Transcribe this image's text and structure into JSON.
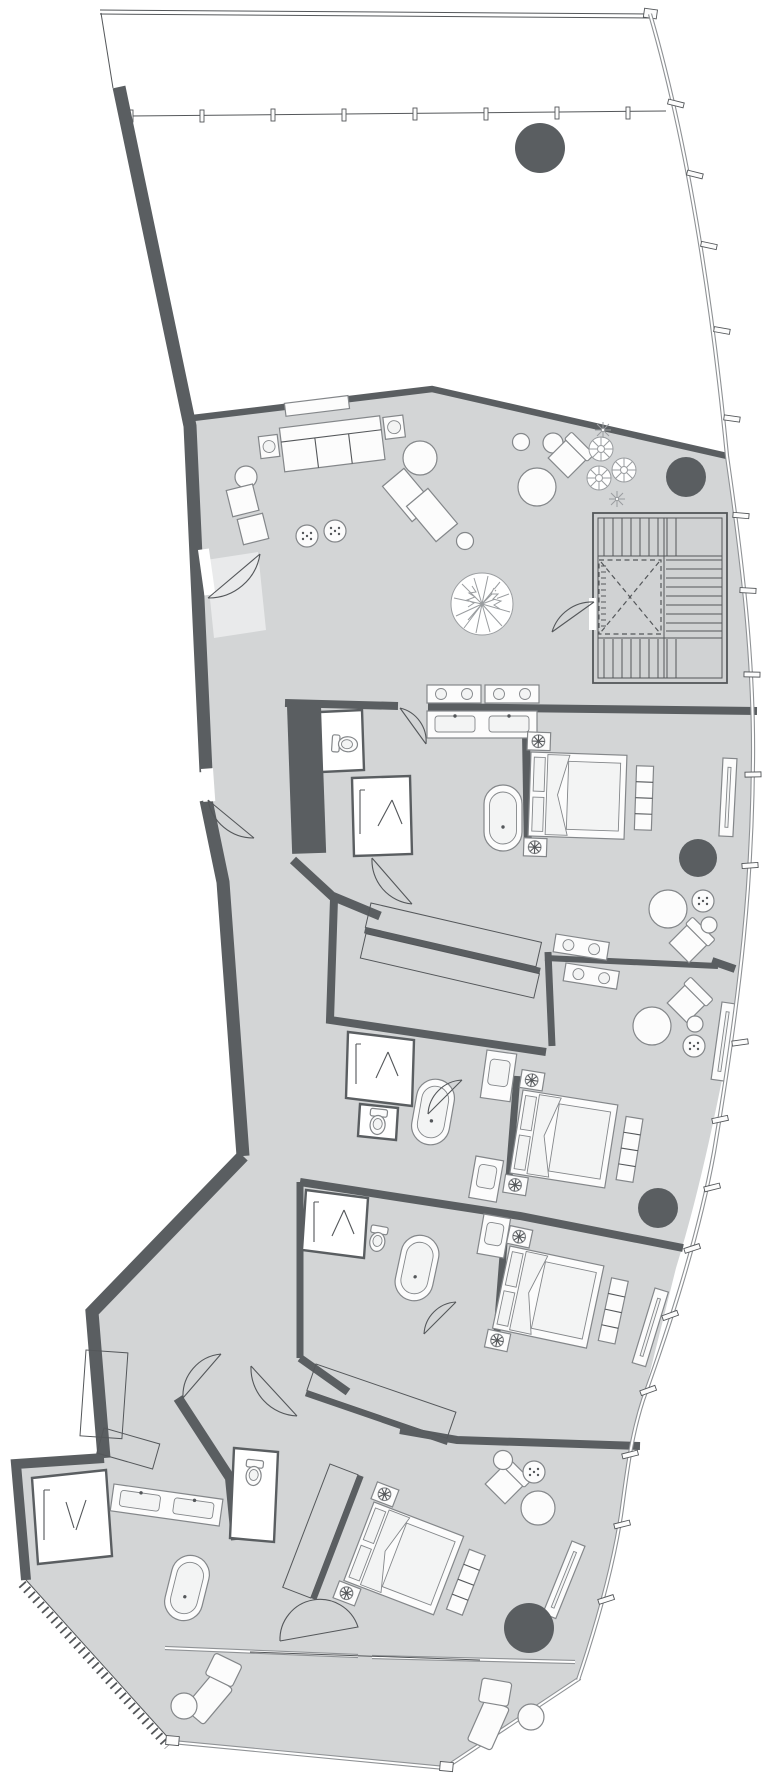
{
  "title": "Penthouse floor plan drawing",
  "colors": {
    "floor": "#d3d5d6",
    "stair": "#d0d2d3",
    "wall": "#5a5e61",
    "line": "#54575a",
    "furn-stroke": "#84878a",
    "white": "#ffffff",
    "pale": "#e9eaeb",
    "glass": "#8f9295",
    "furn-fill": "#fcfcfc",
    "furn2-fill": "#f3f4f4"
  },
  "rooms": [
    {
      "name": "upper-terrace"
    },
    {
      "name": "living-dining-area"
    },
    {
      "name": "stair-core-with-elevator"
    },
    {
      "name": "entry-hall"
    },
    {
      "name": "gallery-corridor"
    },
    {
      "name": "bedroom-suite-1"
    },
    {
      "name": "bedroom-suite-2"
    },
    {
      "name": "bedroom-suite-3"
    },
    {
      "name": "master-suite"
    },
    {
      "name": "walk-in-closet"
    },
    {
      "name": "master-bathroom"
    },
    {
      "name": "lower-terrace"
    }
  ],
  "inventory": {
    "beds": 4,
    "freestanding_bathtubs": 4,
    "showers": 4,
    "toilets": 4,
    "double_vanities": 2,
    "structural_columns": 5,
    "stair_flights": 3,
    "elevators": 1,
    "sofas": 1,
    "chaise_lounges": 2,
    "wardrobe_runs": 4,
    "planter_boxes": 4,
    "trees_plants": 5
  },
  "icon_names": [
    "bed-icon",
    "bathtub-icon",
    "toilet-icon",
    "shower-icon",
    "sink-icon",
    "lamp-flower-icon",
    "tv-panel-icon",
    "column-icon",
    "tree-icon",
    "bush-icon",
    "stair-icon",
    "elevator-x-icon",
    "door-swing-icon",
    "pouf-icon",
    "chaise-icon"
  ]
}
